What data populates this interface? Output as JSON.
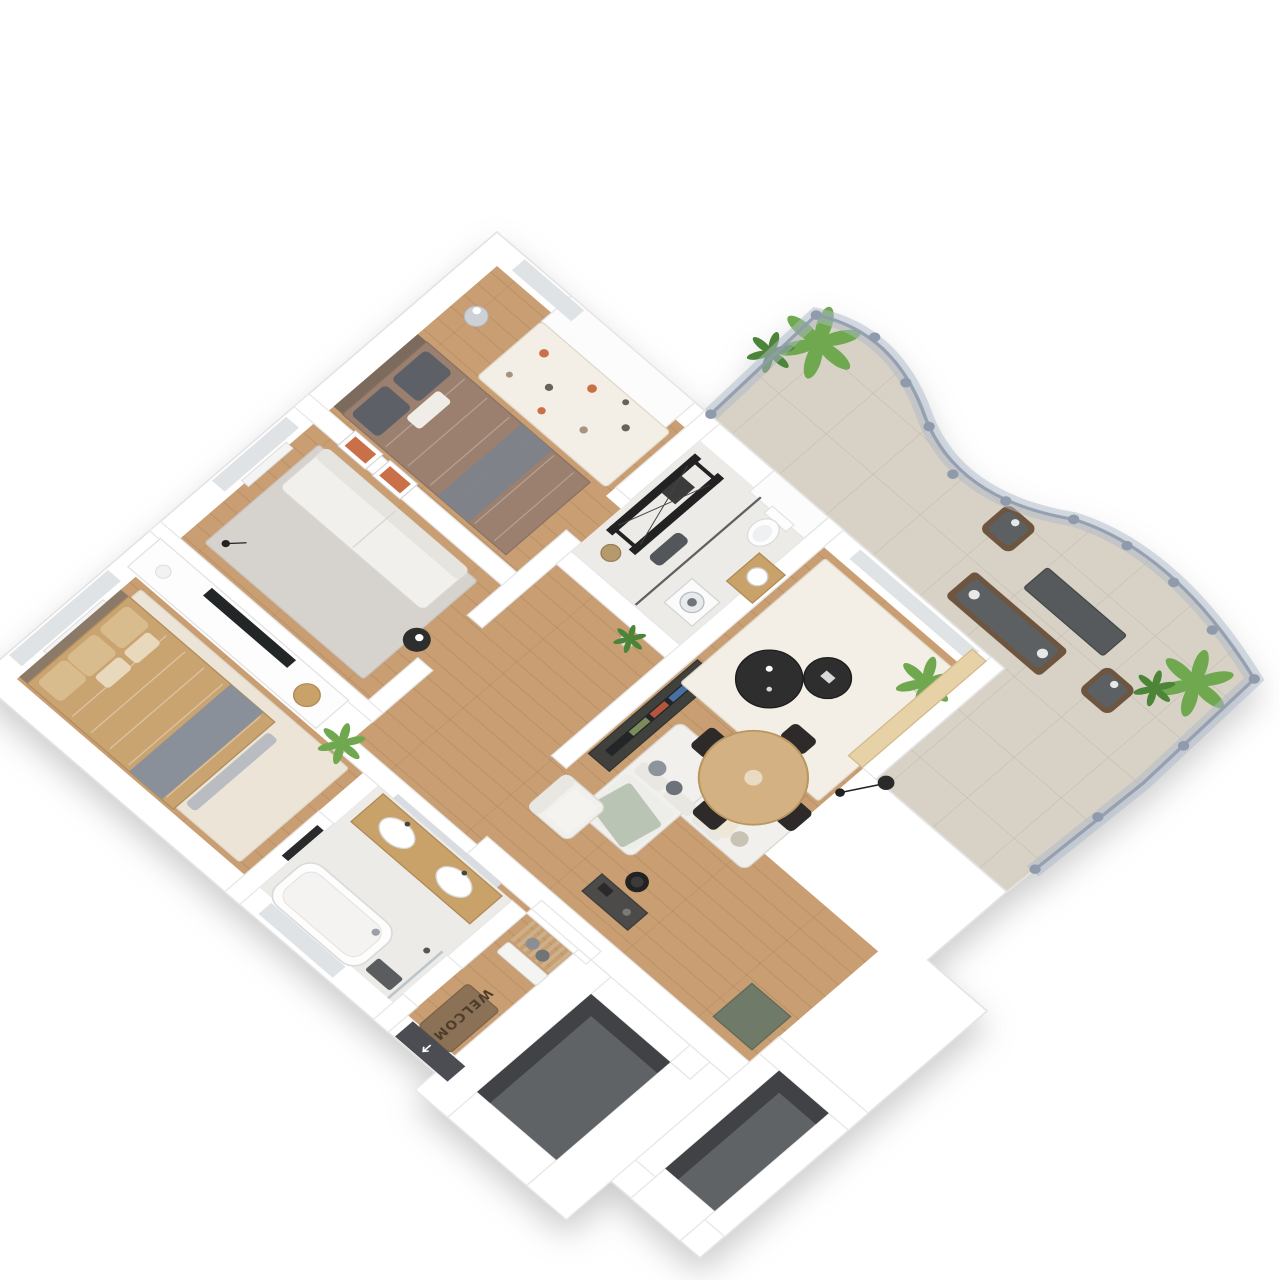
{
  "scene": {
    "title": "3d-isometric-apartment-floorplan",
    "background": "#ffffff"
  },
  "entry": {
    "doormat_text": "WELCOME"
  },
  "colors": {
    "wall": "#ffffff",
    "wall_edge": "#e3e3e3",
    "wood_floor": "#c89e72",
    "tile_bath": "#edebe7",
    "terrace_tile": "#d8d1c5",
    "void_floor": "#616466",
    "void_wall": "#3f4244",
    "rug_cream": "#ece4d6",
    "rug_gray": "#d6d3ce",
    "rug_white": "#f3efe6",
    "sofa_white": "#f1f0ed",
    "sofa_shadow": "#d9d7d1",
    "bed_tan": "#c9a471",
    "blanket_gray": "#8a9099",
    "bed_brown": "#9b8070",
    "pillow_dark": "#5d6066",
    "table_black": "#2d2d2e",
    "dining_wood": "#d3b183",
    "chair_black": "#2e2c29",
    "counter_beige": "#e7d2a8",
    "outdoor_cushion": "#5d6163",
    "outdoor_frame": "#6e5540",
    "outdoor_table": "#565a5c",
    "plant_green": "#6fa84f",
    "plant_dark": "#4e8538",
    "pot_gray": "#dfe0de",
    "fence_glass": "#aeb9c9",
    "fence_post": "#8f9bad",
    "door_dark": "#4b4e53",
    "mat_brown": "#8b7156",
    "accent_orange": "#c96f4a",
    "sage": "#b7c2b2",
    "wood_furniture": "#c9a26b",
    "tv_dark": "#232528",
    "green_cube": "#6f7a68",
    "desk_dark": "#4d4b48",
    "metal_black": "#232323",
    "window_glass": "#dfe3e6"
  },
  "rooms": {
    "bedroom_small": {
      "furniture": [
        "wardrobe",
        "double-bed",
        "patterned-rug",
        "wall-art",
        "mirror-ball"
      ]
    },
    "lounge": {
      "furniture": [
        "sofa",
        "area-rug",
        "side-table",
        "tv-sideboard",
        "tv"
      ]
    },
    "bedroom_primary": {
      "furniture": [
        "double-bed",
        "area-rug",
        "foot-bench",
        "dresser",
        "decor-plate",
        "plant"
      ]
    },
    "bathroom_primary": {
      "furniture": [
        "double-vanity",
        "mirror",
        "bathtub",
        "towel-rack",
        "shower"
      ]
    },
    "entry_hall": {
      "furniture": [
        "coat-rack",
        "bench",
        "doormat",
        "entrance-door"
      ]
    },
    "gym_laundry": {
      "furniture": [
        "cable-machine",
        "workout-bench",
        "glass-partition",
        "washing-machine",
        "toilet",
        "sink-cabinet",
        "laundry-basket"
      ]
    },
    "living_room": {
      "furniture": [
        "sectional-sofa",
        "armchair",
        "coffee-tables",
        "area-rug",
        "floor-lamp",
        "plant",
        "tv-console",
        "dining-table",
        "dining-chairs",
        "terrace-counter",
        "desk",
        "desk-chair",
        "storage-cube"
      ]
    },
    "terrace": {
      "furniture": [
        "outdoor-sofa",
        "outdoor-table",
        "outdoor-armchairs",
        "plants",
        "glass-fence"
      ]
    },
    "voids": [
      "stairwell-opening-1",
      "stairwell-opening-2"
    ]
  }
}
